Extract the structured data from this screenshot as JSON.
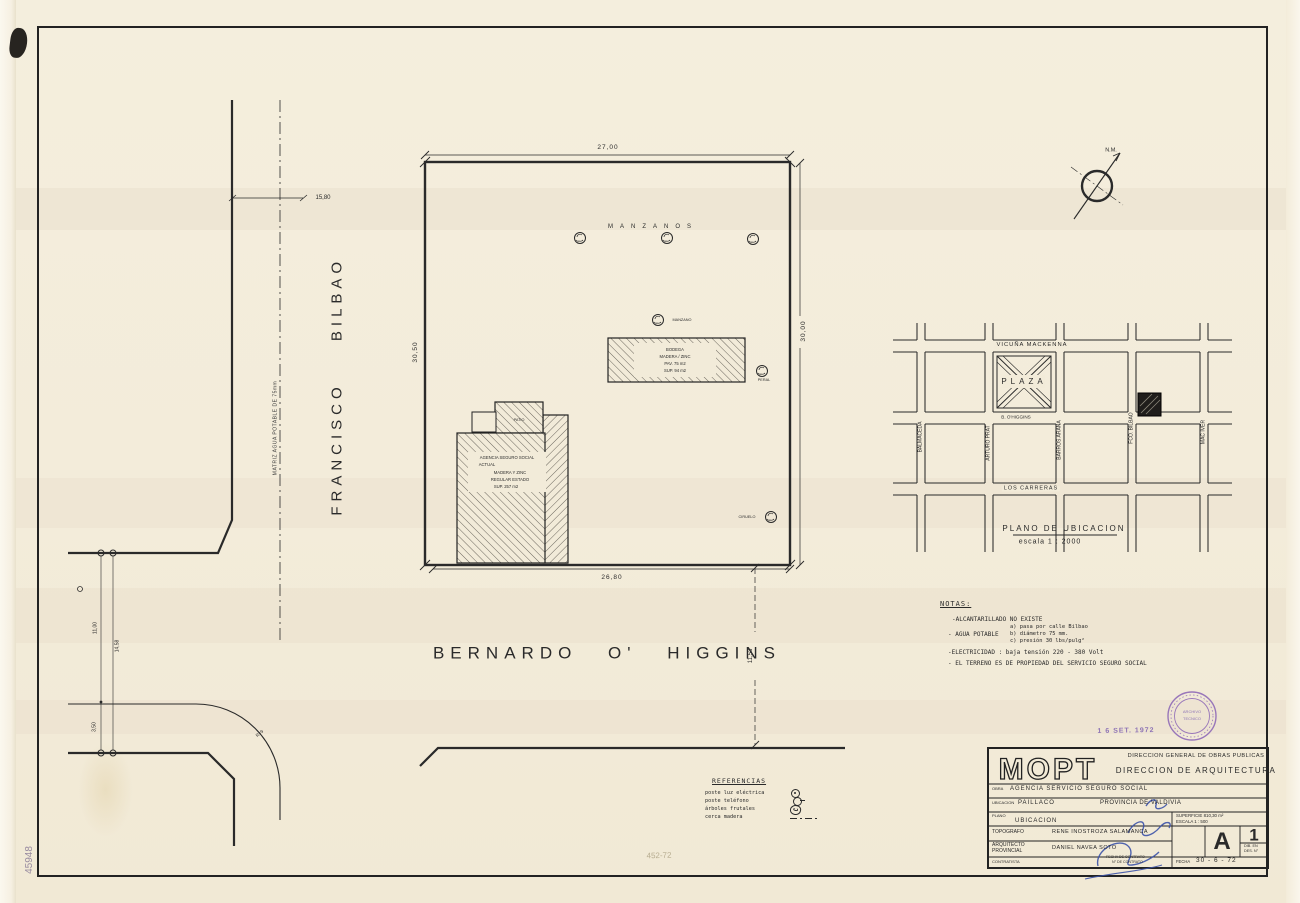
{
  "streets": {
    "left_top": "BILBAO",
    "left_bottom": "FRANCISCO",
    "water_main": "MATRIZ  AGUA  POTABLE  DE  75mm",
    "bottom": "BERNARDO   O' HIGGINS"
  },
  "dims": {
    "top": "27,00",
    "right": "30,00",
    "left": "30,50",
    "bottom": "26,80",
    "setback": "15,80",
    "street_width": "11,53",
    "c1": "11,00",
    "c2": "14,58",
    "c3": "3,50",
    "radius": "R=9"
  },
  "lot": {
    "orchard_label": "MANZANOS",
    "tree1": "MANZANO",
    "tree2": "PERAL",
    "tree3": "CIRUELO"
  },
  "shed": {
    "l1": "BODEGA",
    "l2": "MADERA / ZINC",
    "l3": "PAV.  75 m2",
    "l4": "SUP.  94 m2"
  },
  "building": {
    "l1": "AGENCIA  SEGURO  SOCIAL",
    "l2": "ACTUAL",
    "l3": "MADERA  Y  ZINC",
    "l4": "REGULAR  ESTADO",
    "l5": "SUP.  257 m2",
    "annex": "PATIO"
  },
  "north_label": "N.M.",
  "inset_map": {
    "h1": "VICUÑA   MACKENNA",
    "h2": "B. O'HIGGINS",
    "h3": "LOS   CARRERAS",
    "v1": "BALMACEDA",
    "v2": "ARTURO   PRAT",
    "v3": "BARROS   ARANA",
    "v4": "FCO.   BILBAO",
    "v5": "MAC   IVER",
    "plaza": "PLAZA",
    "caption": "PLANO   DE   UBICACION",
    "scale": "escala   1 : 2000"
  },
  "notes": {
    "title": "NOTAS:",
    "n1": "-ALCANTARILLADO    NO    EXISTE",
    "n2": "- AGUA    POTABLE",
    "n2a": "a) pasa  por  calle   Bilbao",
    "n2b": "b) diámetro  75 mm.",
    "n2c": "c) presión  30 lbs/pulg²",
    "n3": "-ELECTRICIDAD : baja  tensión  220 - 380  Volt",
    "n4": "- EL  TERRENO  ES  DE  PROPIEDAD  DEL   SERVICIO  SEGURO  SOCIAL"
  },
  "references": {
    "title": "REFERENCIAS",
    "r1": "poste  luz  eléctrica",
    "r2": "poste  teléfono",
    "r3": "árboles  frutales",
    "r4": "cerca  madera"
  },
  "title_block": {
    "logo": "MOPT",
    "org1": "DIRECCION  GENERAL  DE  OBRAS  PUBLICAS",
    "org2": "DIRECCION   DE   ARQUITECTURA",
    "obra_label": "OBRA",
    "obra": "AGENCIA    SERVICIO    SEGURO     SOCIAL",
    "ubicacion_label": "UBICACION",
    "ubicacion": "PAILLACO",
    "provincia": "PROVINCIA   DE   VALDIVIA",
    "plano_label": "PLANO",
    "plano": "UBICACION",
    "superficie": "SUPERFICIE   810,30 m²",
    "escala": "ESCALA    1 : 500",
    "topografo_label": "TOPOGRAFO",
    "topografo": "RENE    INOSTROZA    SALAMANCA",
    "arquitecto_label1": "ARQUITECTO",
    "arquitecto_label2": "PROVINCIAL",
    "arquitecto": "DANIEL    NAVEA    SOTO",
    "contratista_label": "CONTRATISTA",
    "firma_note1": "FECHA DE CONTRATO",
    "firma_note2": "N° DE CONTRATO",
    "sheet_letter": "A",
    "sheet_number": "1",
    "sheet_sub1": "DIB. EN",
    "sheet_sub2": "DES. N°",
    "fecha_label": "FECHA",
    "fecha": "30 - 6 - 72"
  },
  "stamps": {
    "date": "1 6 SET. 1972",
    "seal_line1": "ARCHIVO",
    "seal_line2": "TECNICO"
  },
  "pencil": {
    "left": "45948",
    "center": "452-72"
  },
  "colors": {
    "paper": "#f2ebd9",
    "ink": "#2a2a2a",
    "purple": "#7d5fb0",
    "blue": "#3850a8"
  }
}
